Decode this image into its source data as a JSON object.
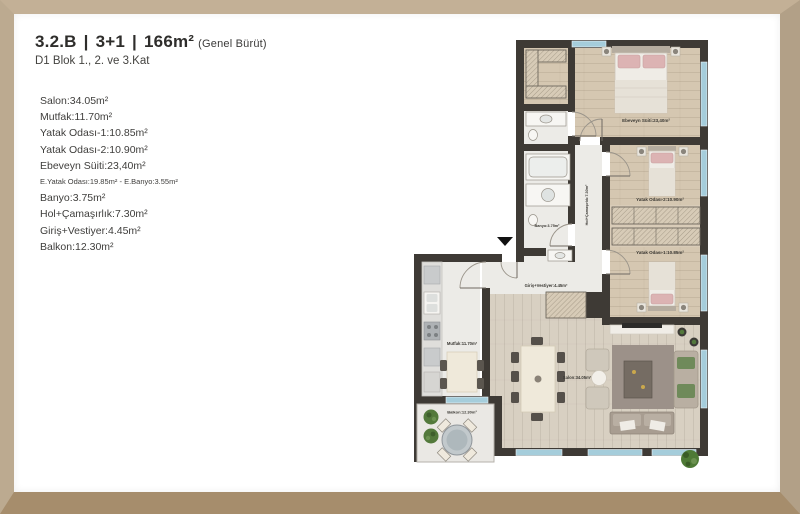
{
  "header": {
    "unit_code": "3.2.B",
    "separator": "|",
    "room_config": "3+1",
    "gross_area": "166m²",
    "gross_area_note": "(Genel Bürüt)",
    "subtitle": "D1 Blok 1., 2. ve 3.Kat"
  },
  "legend": {
    "items": [
      {
        "text": "Salon:34.05m²",
        "size": "normal"
      },
      {
        "text": "Mutfak:11.70m²",
        "size": "normal"
      },
      {
        "text": "Yatak Odası-1:10.85m²",
        "size": "normal"
      },
      {
        "text": "Yatak Odası-2:10.90m²",
        "size": "normal"
      },
      {
        "text": "Ebeveyn Süiti:23,40m²",
        "size": "normal"
      },
      {
        "text": "E.Yatak Odası:19.85m² - E.Banyo:3.55m²",
        "size": "small"
      },
      {
        "text": "Banyo:3.75m²",
        "size": "normal"
      },
      {
        "text": "Hol+Çamaşırlık:7.30m²",
        "size": "normal"
      },
      {
        "text": "Giriş+Vestiyer:4.45m²",
        "size": "normal"
      },
      {
        "text": "Balkon:12.30m²",
        "size": "normal"
      }
    ]
  },
  "plan": {
    "rooms": {
      "ebeveyn": "Ebeveyn Süiti:23,40m²",
      "yatak2": "Yatak Odası-2:10.90m²",
      "yatak1": "Yatak Odası-1:10.85m²",
      "banyo": "Banyo:3.75m²",
      "hol": "Hol+Çamaşırlık:7.30m²",
      "giris": "Giriş+Vestiyer:4.45m²",
      "mutfak": "Mutfak:11.70m²",
      "salon": "Salon:34.05m²",
      "balkon": "Balkon:12.30m²"
    },
    "entrance_marker": "entrance-arrow"
  },
  "colors": {
    "frame_wood": "#bcaa90",
    "wall": "#3e3a35",
    "wood_floor": "#d5c7b1",
    "salon_floor": "#d8d0c2",
    "light_floor": "#ecebe7",
    "window_glass": "#a5cddb",
    "pillow_pink": "#dcb3b3",
    "rug": "#9c9189",
    "plant_green": "#53793b",
    "text": "#3f3e3c"
  }
}
